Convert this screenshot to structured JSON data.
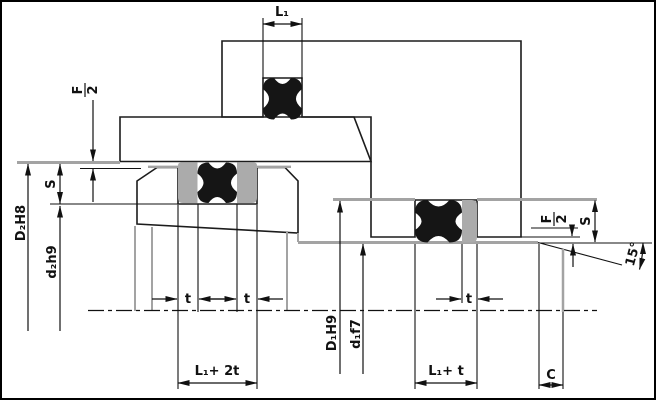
{
  "drawing": {
    "colors": {
      "background": "#ffffff",
      "outline": "#1c1c1c",
      "hatch": "#1c1c1c",
      "seal_black": "#151515",
      "backup_gray": "#ababab",
      "surface_gray": "#a3a3a3"
    },
    "dims": {
      "l1": "L₁",
      "f_num": "F",
      "f_den": "2",
      "s": "S",
      "d2_bore": "D₂H8",
      "d2_groove": "d₂h9",
      "t": "t",
      "l1_2t": "L₁+ 2t",
      "d1_bore": "D₁H9",
      "d1_rod": "d₁f7",
      "l1_t": "L₁+ t",
      "c": "C",
      "angle": "15°"
    }
  }
}
